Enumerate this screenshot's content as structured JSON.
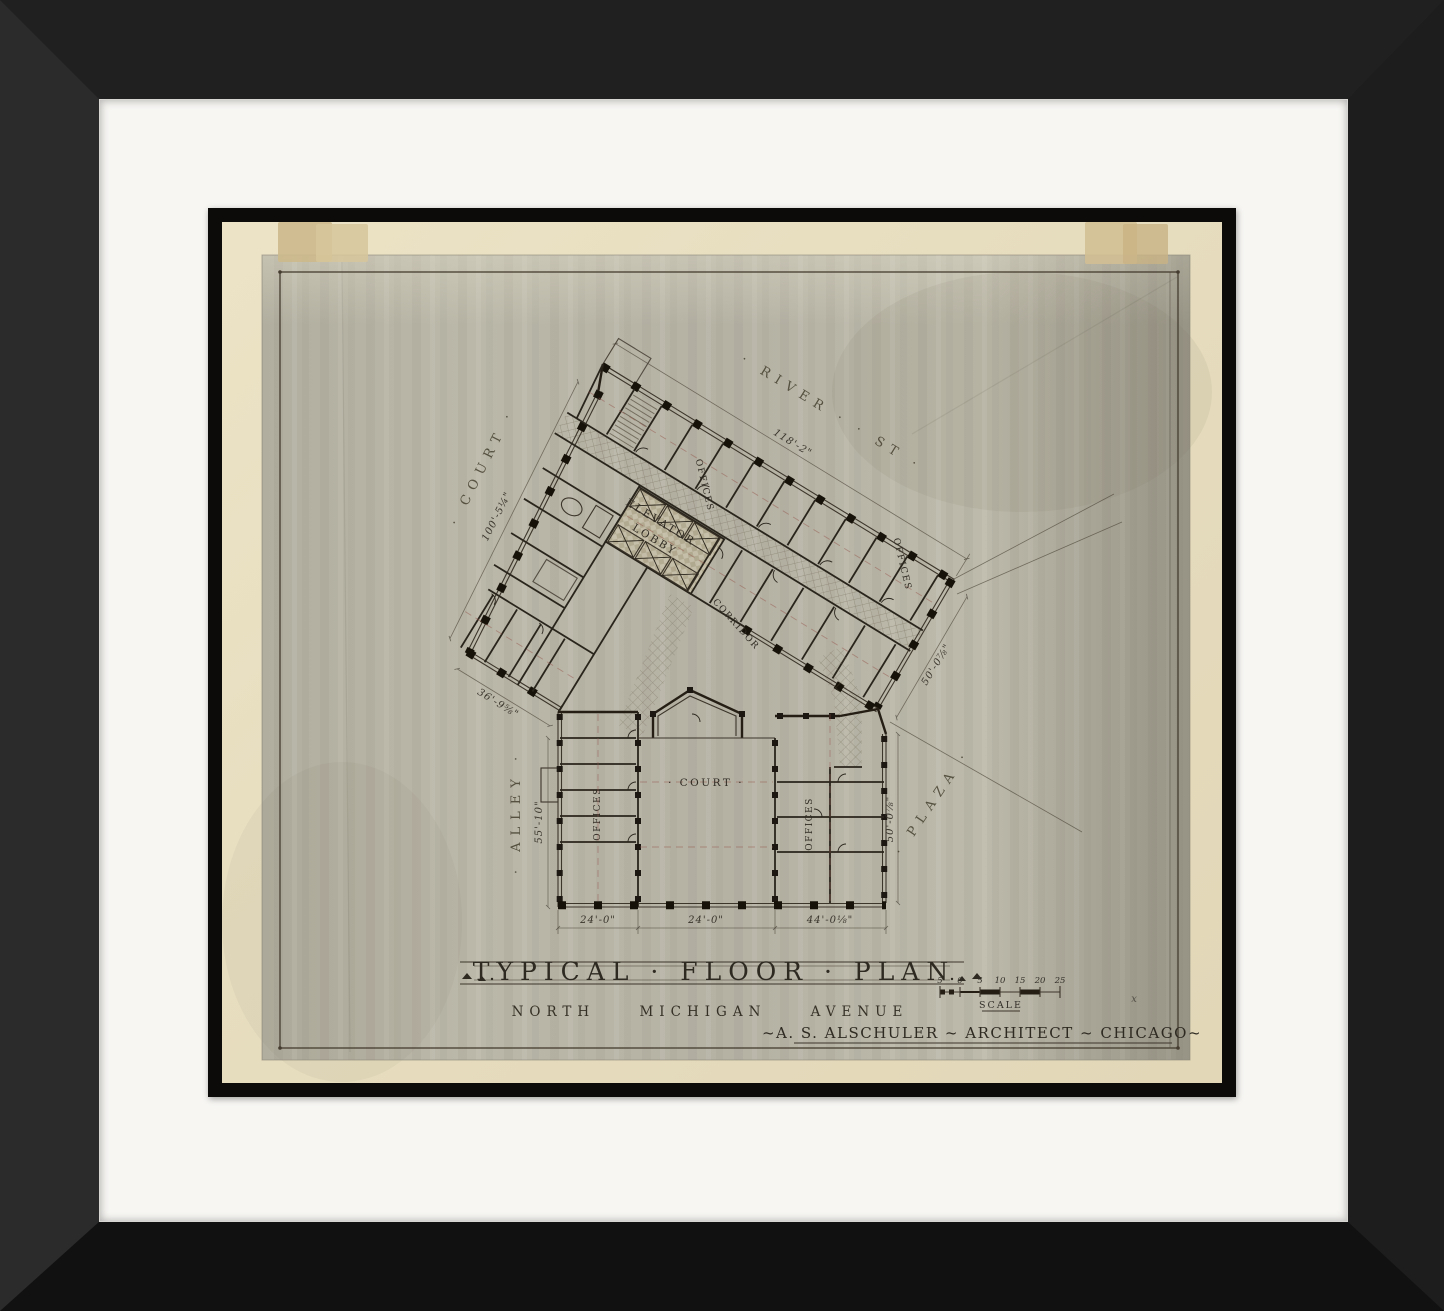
{
  "artwork": {
    "kind": "framed architectural drawing",
    "colors": {
      "frame": "#1b1b1b",
      "mat": "#f7f6f3",
      "fillet": "#0c0b0a",
      "paper": "#e7ddc0",
      "wash": "#b8b5a7",
      "ink": "#33302a",
      "accent_red": "#96584d",
      "tape": "#cdb98c"
    }
  },
  "title_block": {
    "title": "TYPICAL · FLOOR · PLAN",
    "subtitle": "NORTH MICHIGAN AVENUE",
    "architect": "~A. S. ALSCHULER ~ ARCHITECT ~ CHICAGO~",
    "mark": "x"
  },
  "scale_bar": {
    "label": "SCALE",
    "ticks": [
      "5",
      "0",
      "5",
      "10",
      "15",
      "20",
      "25"
    ]
  },
  "streets": {
    "river": "· RIVER ·  · ST ·",
    "court": "· COURT ·",
    "alley": "· ALLEY ·",
    "plaza": "· PLAZA ·"
  },
  "rooms": {
    "elevator_lobby_line1": "ELEVATOR",
    "elevator_lobby_line2": "LOBBY",
    "corridor": "CORRIDOR",
    "court": "· COURT ·",
    "offices_upper": "OFFICES",
    "offices_upper_right": "OFFICES",
    "offices_left_wing": "OFFICES",
    "offices_right_wing": "OFFICES"
  },
  "dimensions": {
    "river_frontage": "118'-2\"",
    "court_frontage": "100'-5¼\"",
    "southwest_facade": "36'-9⅝\"",
    "alley_side": "55'-10\"",
    "bottom_left": "24'-0\"",
    "bottom_center": "24'-0\"",
    "bottom_right": "44'-0⅛\"",
    "east_end": "50'-0⅞\"",
    "plaza_side": "50'-0⅞\""
  }
}
